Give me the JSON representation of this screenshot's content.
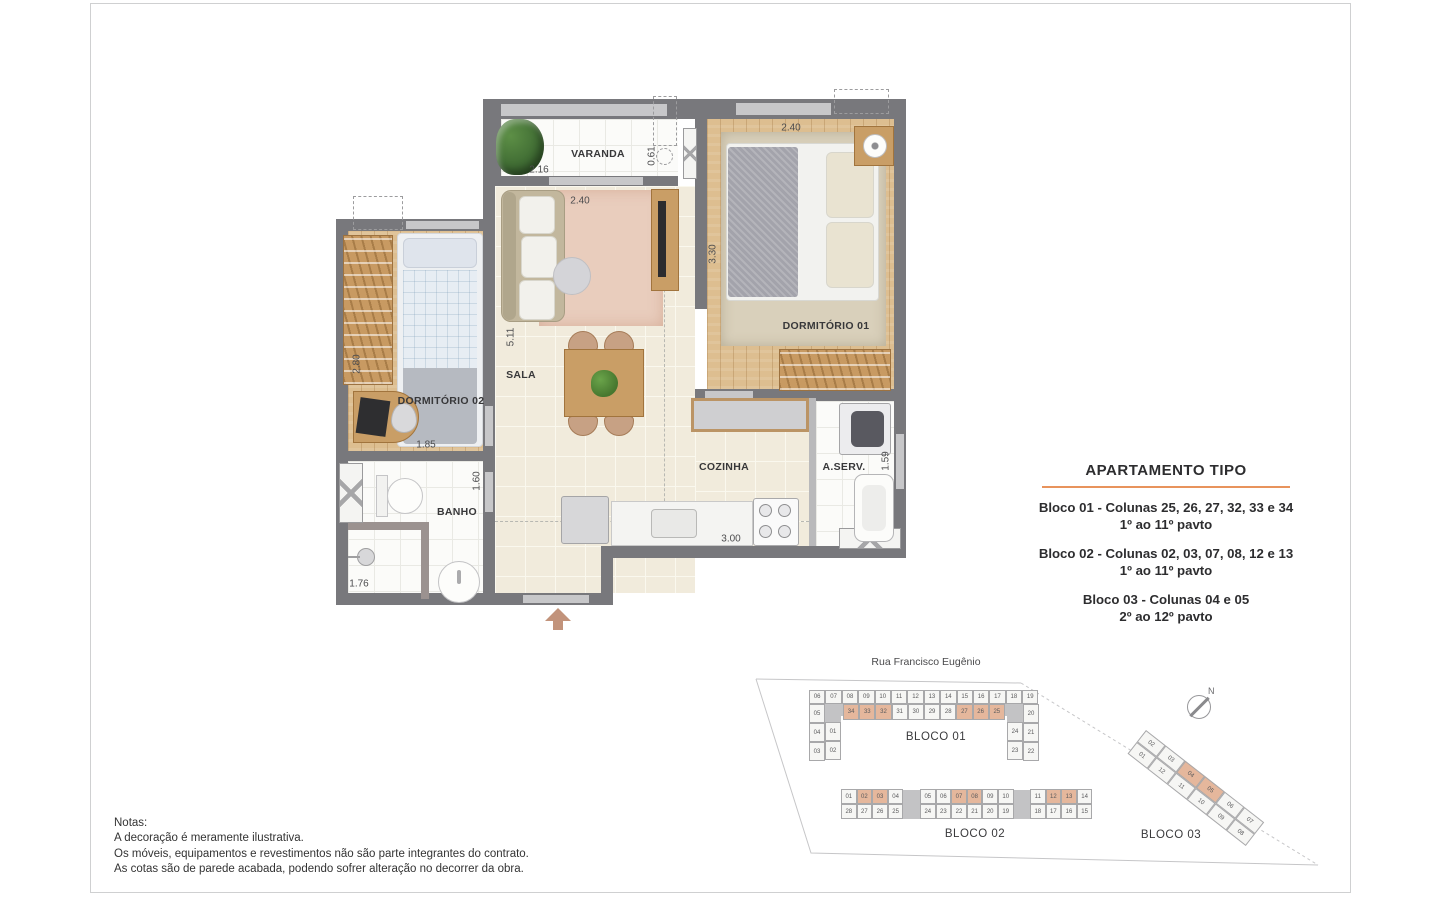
{
  "floorplan": {
    "rooms": {
      "varanda": "VARANDA",
      "sala": "SALA",
      "dormitorio_01": "DORMITÓRIO 01",
      "dormitorio_02": "DORMITÓRIO 02",
      "banho": "BANHO",
      "cozinha": "COZINHA",
      "area_servico": "A.SERV."
    },
    "dimensions": {
      "varanda_width": "2.16",
      "varanda_depth": "0.61",
      "sala_width": "2.40",
      "sala_length": "5.11",
      "dorm1_width": "2.40",
      "dorm1_length": "3.30",
      "dorm2_length": "2.80",
      "dorm2_width": "1.85",
      "banho_length": "1.60",
      "banho_width": "1.76",
      "cozinha_width": "3.00",
      "aserv_length": "1.59"
    }
  },
  "info_panel": {
    "title": "APARTAMENTO TIPO",
    "blocks": [
      {
        "line1": "Bloco 01 - Colunas 25, 26, 27, 32, 33 e 34",
        "line2": "1º ao 11º pavto"
      },
      {
        "line1": "Bloco 02 - Colunas 02, 03, 07, 08, 12 e 13",
        "line2": "1º ao 11º pavto"
      },
      {
        "line1": "Bloco 03 - Colunas 04 e 05",
        "line2": "2º ao 12º pavto"
      }
    ]
  },
  "site_plan": {
    "street": "Rua Francisco Eugênio",
    "north": "N",
    "bloco01": {
      "label": "BLOCO 01",
      "top_row": [
        "06",
        "07",
        "08",
        "09",
        "10",
        "11",
        "12",
        "13",
        "14",
        "15",
        "16",
        "17",
        "18",
        "19"
      ],
      "inner_row": [
        "34",
        "33",
        "32",
        "31",
        "30",
        "29",
        "28",
        "27",
        "26",
        "25"
      ],
      "left_outer": [
        "05",
        "04",
        "03"
      ],
      "left_inner": [
        "01",
        "02"
      ],
      "right_outer": [
        "20",
        "21",
        "22"
      ],
      "right_inner": [
        "24",
        "23"
      ],
      "highlighted": [
        "34",
        "33",
        "32",
        "27",
        "26",
        "25"
      ]
    },
    "bloco02": {
      "label": "BLOCO 02",
      "top_groups": [
        [
          "01",
          "02",
          "03",
          "04"
        ],
        [
          "05",
          "06",
          "07",
          "08",
          "09",
          "10"
        ],
        [
          "11",
          "12",
          "13",
          "14"
        ]
      ],
      "bottom_groups": [
        [
          "28",
          "27",
          "26",
          "25"
        ],
        [
          "24",
          "23",
          "22",
          "21",
          "20",
          "19"
        ],
        [
          "18",
          "17",
          "16",
          "15"
        ]
      ],
      "highlighted": [
        "02",
        "03",
        "07",
        "08",
        "12",
        "13"
      ]
    },
    "bloco03": {
      "label": "BLOCO 03",
      "top_row": [
        "02",
        "03",
        "04",
        "05",
        "06",
        "07"
      ],
      "bottom_row": [
        "01",
        "12",
        "11",
        "10",
        "09",
        "08"
      ],
      "highlighted": [
        "04",
        "05"
      ]
    }
  },
  "notes": {
    "title": "Notas:",
    "lines": [
      "A decoração é meramente ilustrativa.",
      "Os móveis, equipamentos e revestimentos não são parte integrantes do contrato.",
      "As cotas são de parede acabada, podendo sofrer alteração no decorrer da obra."
    ]
  },
  "colors": {
    "wall": "#78787c",
    "wall_light": "#c7c7c9",
    "highlight": "#e5b79c",
    "accent_orange": "#e8935c",
    "arrow": "#c2937b"
  }
}
